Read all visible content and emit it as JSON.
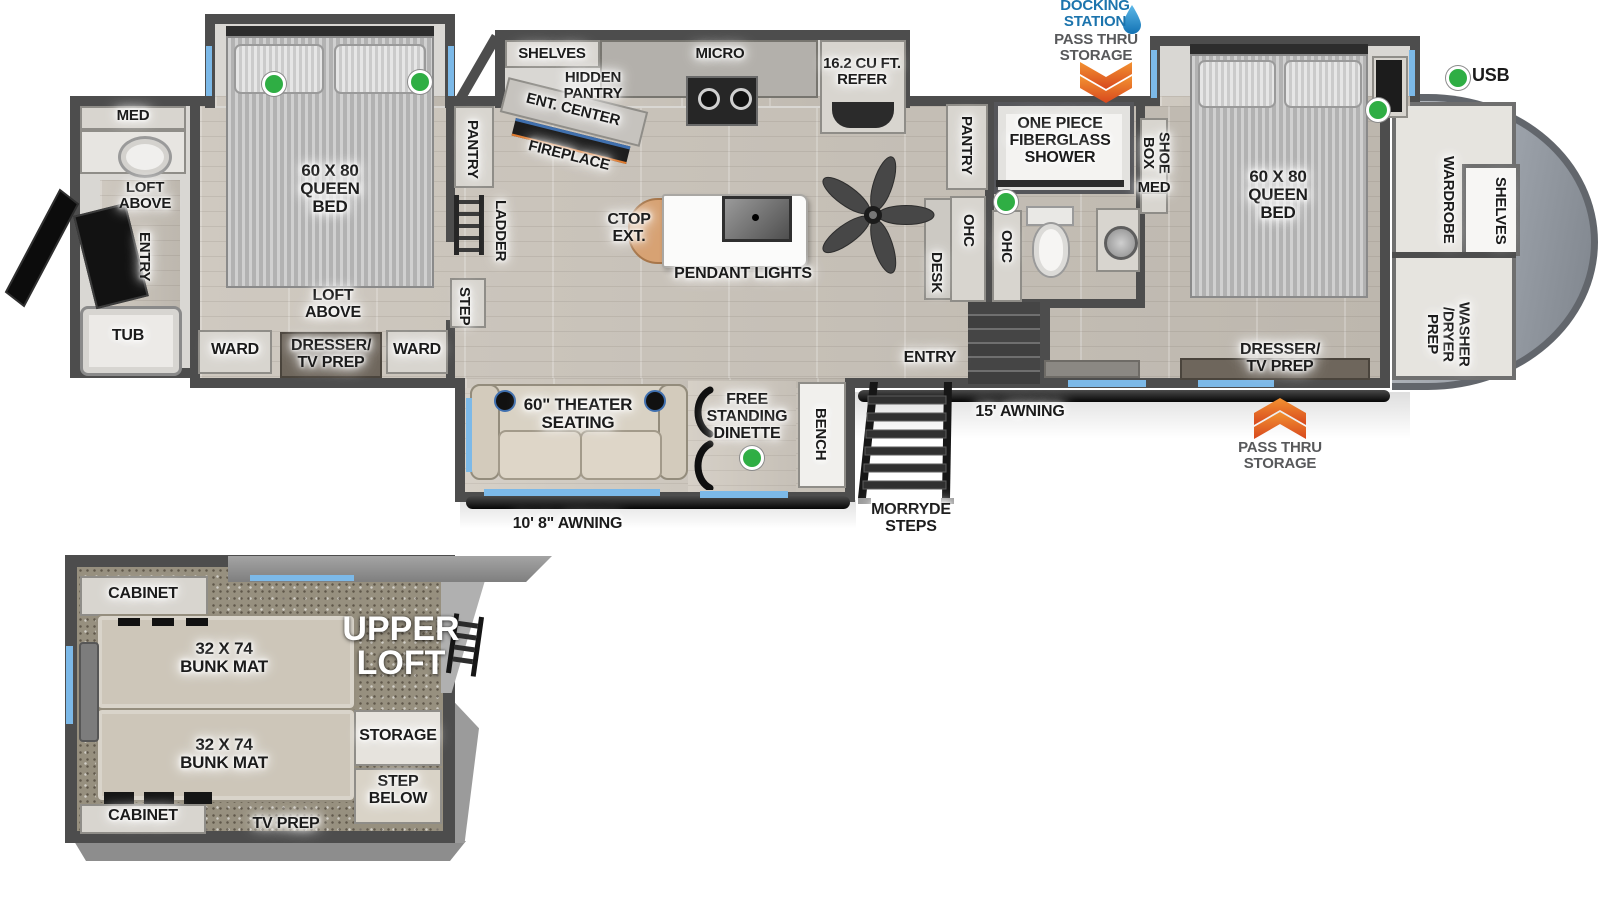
{
  "colors": {
    "wall": "#4d4d4d",
    "accent_blue_text": "#1c74ad",
    "window_blue": "#7cb9e8",
    "status_green": "#2fae44",
    "arrow_orange": "#e8731e",
    "label_gray": "#58595b"
  },
  "exterior": {
    "docking_station": "DOCKING STATION",
    "pass_thru_top": "PASS THRU STORAGE",
    "pass_thru_bottom": "PASS THRU STORAGE",
    "usb": "USB",
    "awning_garage": "10' 8\" AWNING",
    "awning_main": "15' AWNING",
    "morryde_steps": "MORRYDE STEPS"
  },
  "rear_bath": {
    "med": "MED",
    "loft_above": "LOFT ABOVE",
    "entry": "ENTRY",
    "tub": "TUB"
  },
  "bedroom2": {
    "bed": "60 X 80 QUEEN BED",
    "loft_above": "LOFT ABOVE",
    "ward_left": "WARD",
    "dresser_tv": "DRESSER/ TV PREP",
    "ward_right": "WARD"
  },
  "hall": {
    "pantry": "PANTRY",
    "ladder": "LADDER",
    "step": "STEP"
  },
  "kitchen": {
    "shelves": "SHELVES",
    "hidden_pantry": "HIDDEN PANTRY",
    "ent_center": "ENT. CENTER",
    "fireplace": "FIREPLACE",
    "micro": "MICRO",
    "refer": "16.2 CU FT. REFER",
    "ctop_ext": "CTOP EXT.",
    "pendant_lights": "PENDANT LIGHTS"
  },
  "living": {
    "pantry": "PANTRY",
    "ohc_left": "OHC",
    "desk": "DESK",
    "ohc_right": "OHC",
    "entry": "ENTRY"
  },
  "mid_bath": {
    "shower": "ONE PIECE FIBERGLASS SHOWER",
    "shoe_box": "SHOE BOX",
    "med": "MED"
  },
  "bedroom1": {
    "bed": "60 X 80 QUEEN BED",
    "dresser_tv": "DRESSER/ TV PREP",
    "wardrobe": "WARDROBE",
    "shelves": "SHELVES",
    "washer_dryer": "WASHER /DRYER PREP"
  },
  "garage": {
    "theater": "60\" THEATER SEATING",
    "dinette": "FREE STANDING DINETTE",
    "bench": "BENCH"
  },
  "loft": {
    "cabinet_top": "CABINET",
    "bunk_top": "32 X 74 BUNK MAT",
    "bunk_bottom": "32 X 74 BUNK MAT",
    "upper_loft": "UPPER LOFT",
    "storage": "STORAGE",
    "step_below": "STEP BELOW",
    "cabinet_bottom": "CABINET",
    "tv_prep": "TV PREP"
  }
}
